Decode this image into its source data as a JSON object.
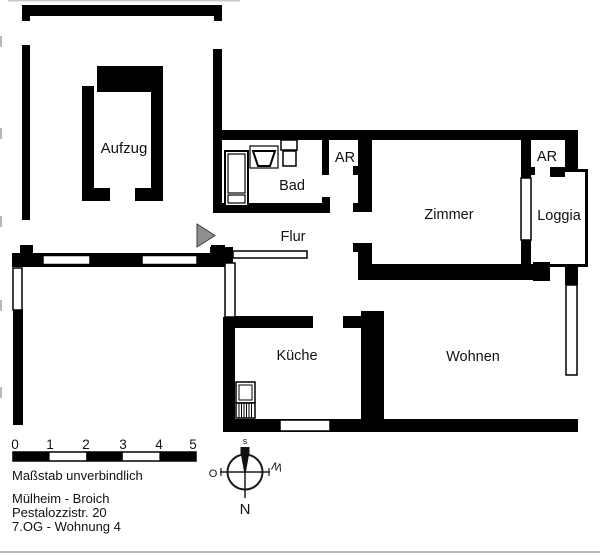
{
  "plan": {
    "rooms": {
      "aufzug": {
        "label": "Aufzug"
      },
      "bad": {
        "label": "Bad"
      },
      "flur": {
        "label": "Flur"
      },
      "ar1": {
        "label": "AR"
      },
      "zimmer": {
        "label": "Zimmer"
      },
      "ar2": {
        "label": "AR"
      },
      "loggia": {
        "label": "Loggia"
      },
      "kueche": {
        "label": "Küche"
      },
      "wohnen": {
        "label": "Wohnen"
      }
    },
    "colors": {
      "wall": "#000000",
      "background": "#ffffff",
      "entrance_marker": "#8f8f8f"
    }
  },
  "scale_bar": {
    "ticks": [
      "0",
      "1",
      "2",
      "3",
      "4",
      "5"
    ],
    "note": "Maßstab unverbindlich"
  },
  "address": {
    "line1": "Mülheim - Broich",
    "line2": "Pestalozzistr. 20",
    "line3": "7.OG - Wohnung 4"
  },
  "compass": {
    "top": "s",
    "left": "O",
    "right": "W",
    "bottom": "N"
  }
}
